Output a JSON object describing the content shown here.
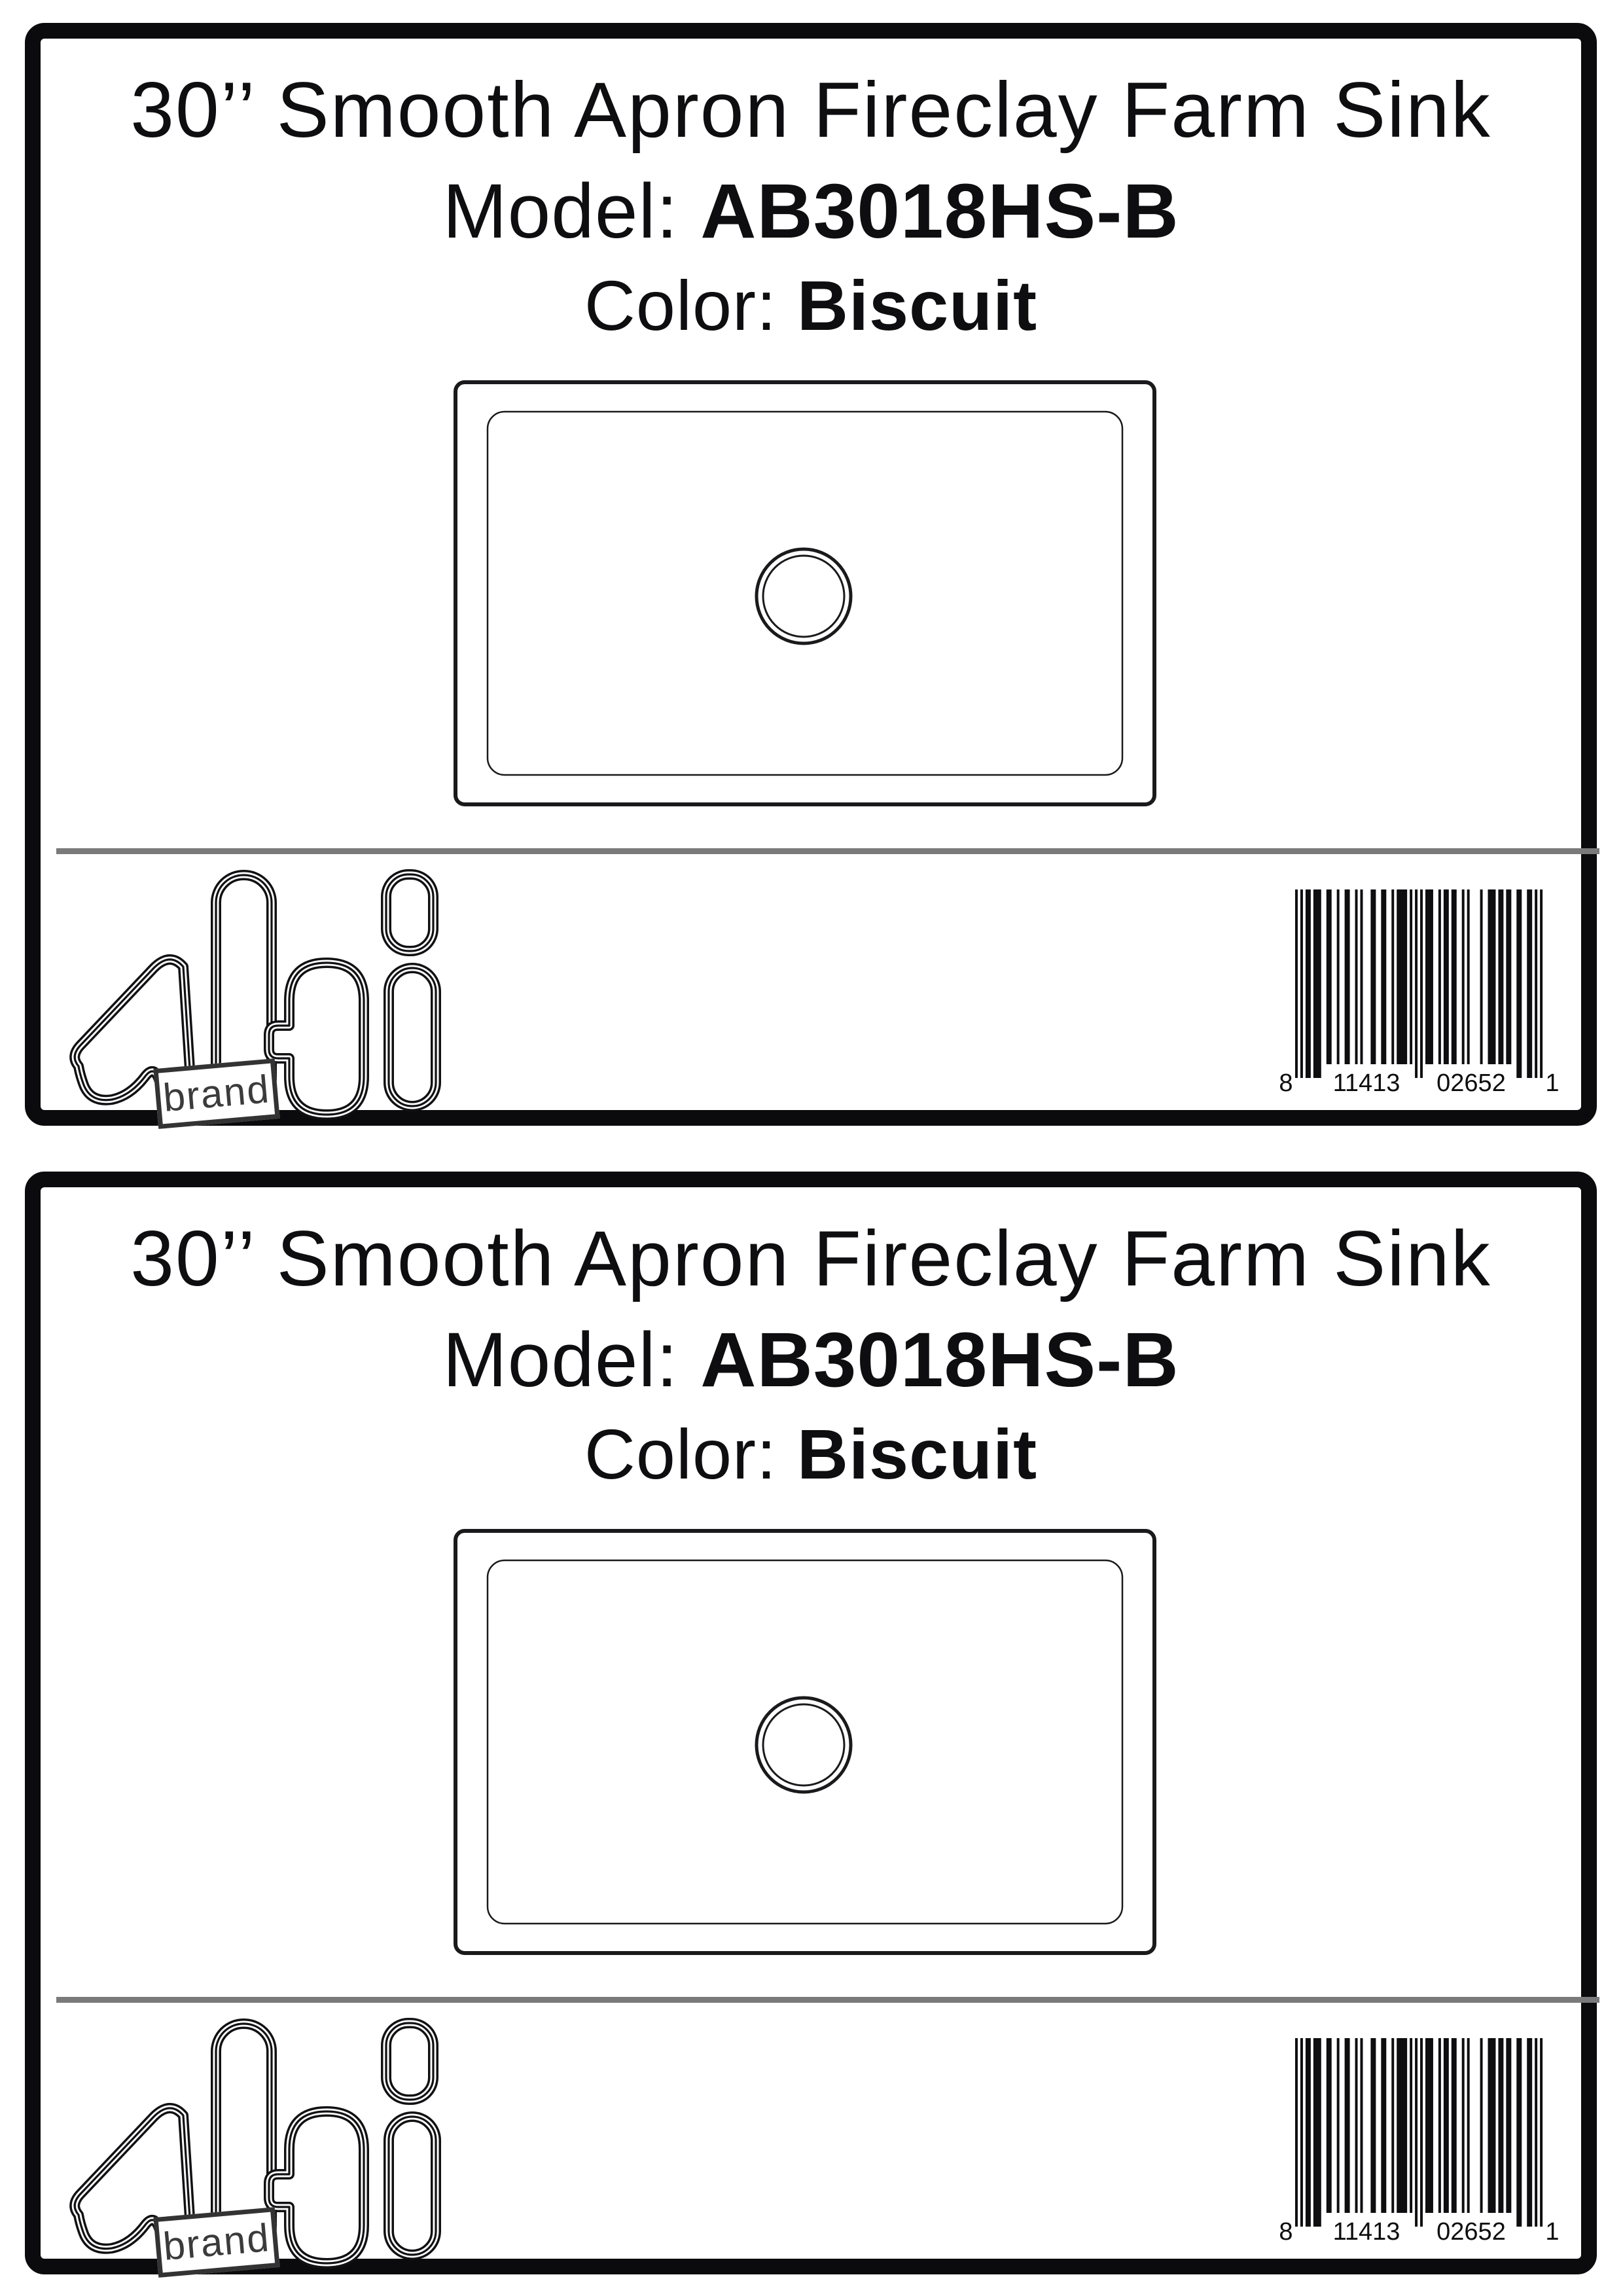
{
  "page": {
    "background": "#ffffff"
  },
  "label": {
    "title": "30’’ Smooth Apron Fireclay Farm Sink",
    "model_label": "Model:",
    "model_value": "AB3018HS-B",
    "color_label": "Color:",
    "color_value": "Biscuit",
    "logo": {
      "word": "alfi",
      "stamp_text": "brand"
    },
    "barcode": {
      "code": "811413026521",
      "left_digit": "8",
      "left_group": "11413",
      "right_group": "02652",
      "right_digit": "1"
    },
    "colors": {
      "ink": "#0e0e10",
      "divider": "#7a7a7a",
      "stamp_ink": "#3b3b3b"
    }
  },
  "labels_count": 2
}
